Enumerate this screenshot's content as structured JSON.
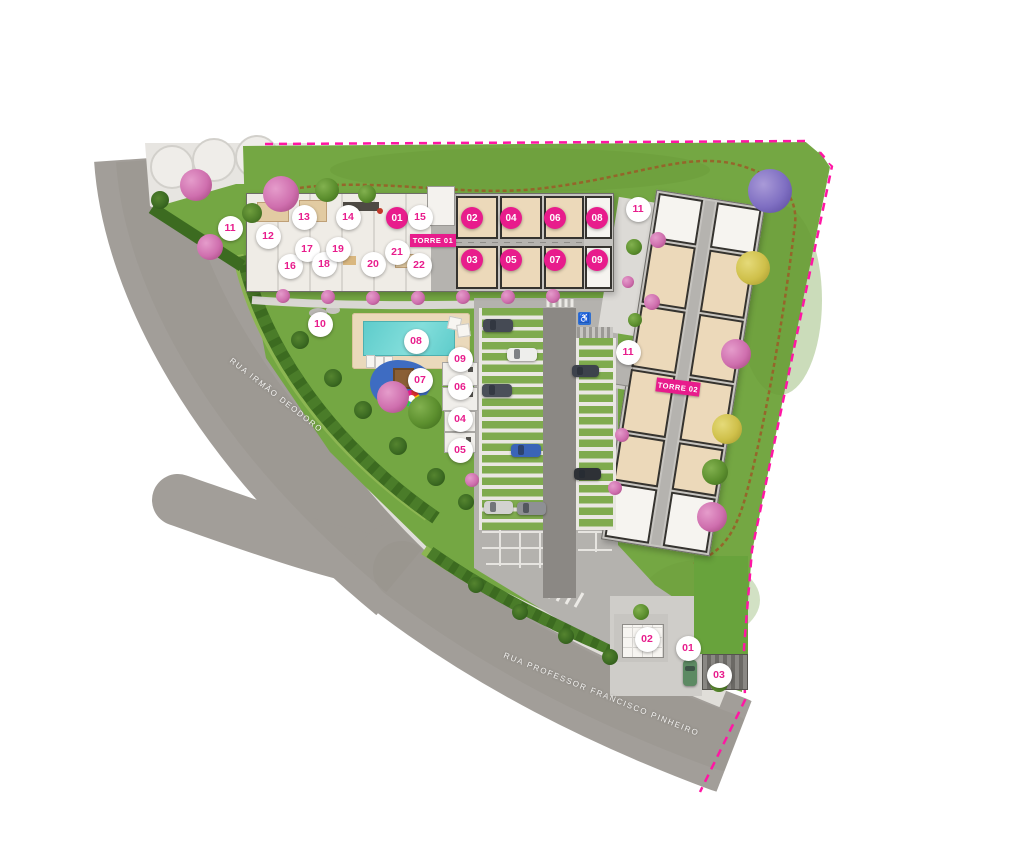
{
  "labels": {
    "torre1": "TORRE 01",
    "torre2": "TORRE 02",
    "street_left": "RUA IRMÃO DEODORO",
    "street_bottom": "RUA PROFESSOR FRANCISCO PINHEIRO"
  },
  "icons": {
    "accessible_parking": "♿"
  },
  "colors": {
    "marker_pink": "#e81c8c",
    "boundary_pink": "#ff16a4",
    "lawn_green": "#74a743",
    "road_gray": "#a29e99",
    "pool_aqua": "#5ecccb",
    "unit_beige": "#ecd9ba",
    "playground_blue": "#3e6cc2"
  },
  "unit_markers": [
    {
      "label": "01",
      "x": 397,
      "y": 218
    },
    {
      "label": "02",
      "x": 472,
      "y": 218
    },
    {
      "label": "04",
      "x": 511,
      "y": 218
    },
    {
      "label": "06",
      "x": 555,
      "y": 218
    },
    {
      "label": "08",
      "x": 597,
      "y": 218
    },
    {
      "label": "03",
      "x": 472,
      "y": 260
    },
    {
      "label": "05",
      "x": 511,
      "y": 260
    },
    {
      "label": "07",
      "x": 555,
      "y": 260
    },
    {
      "label": "09",
      "x": 597,
      "y": 260
    }
  ],
  "amenity_markers": [
    {
      "label": "11",
      "x": 230,
      "y": 228
    },
    {
      "label": "12",
      "x": 268,
      "y": 236
    },
    {
      "label": "13",
      "x": 304,
      "y": 217
    },
    {
      "label": "14",
      "x": 348,
      "y": 217
    },
    {
      "label": "15",
      "x": 420,
      "y": 217
    },
    {
      "label": "16",
      "x": 290,
      "y": 266
    },
    {
      "label": "17",
      "x": 307,
      "y": 249
    },
    {
      "label": "18",
      "x": 324,
      "y": 264
    },
    {
      "label": "19",
      "x": 338,
      "y": 249
    },
    {
      "label": "20",
      "x": 373,
      "y": 264
    },
    {
      "label": "21",
      "x": 397,
      "y": 252
    },
    {
      "label": "22",
      "x": 419,
      "y": 265
    },
    {
      "label": "10",
      "x": 320,
      "y": 324
    },
    {
      "label": "08",
      "x": 416,
      "y": 341
    },
    {
      "label": "07",
      "x": 420,
      "y": 380
    },
    {
      "label": "09",
      "x": 460,
      "y": 359
    },
    {
      "label": "06",
      "x": 460,
      "y": 387
    },
    {
      "label": "04",
      "x": 460,
      "y": 419
    },
    {
      "label": "05",
      "x": 460,
      "y": 450
    },
    {
      "label": "11",
      "x": 638,
      "y": 209
    },
    {
      "label": "11",
      "x": 628,
      "y": 352
    },
    {
      "label": "02",
      "x": 647,
      "y": 639
    },
    {
      "label": "01",
      "x": 688,
      "y": 648
    },
    {
      "label": "03",
      "x": 719,
      "y": 675
    }
  ],
  "trees": [
    {
      "t": "pink",
      "x": 196,
      "y": 185,
      "r": 16
    },
    {
      "t": "pink",
      "x": 281,
      "y": 194,
      "r": 18
    },
    {
      "t": "pink",
      "x": 210,
      "y": 247,
      "r": 13
    },
    {
      "t": "pink",
      "x": 393,
      "y": 397,
      "r": 16
    },
    {
      "t": "pink",
      "x": 736,
      "y": 354,
      "r": 15
    },
    {
      "t": "pink",
      "x": 712,
      "y": 517,
      "r": 15
    },
    {
      "t": "pinksmall",
      "x": 658,
      "y": 240,
      "r": 8
    },
    {
      "t": "pinksmall",
      "x": 652,
      "y": 302,
      "r": 8
    },
    {
      "t": "pinksmall",
      "x": 628,
      "y": 282,
      "r": 6
    },
    {
      "t": "pinksmall",
      "x": 622,
      "y": 435,
      "r": 7
    },
    {
      "t": "pinksmall",
      "x": 615,
      "y": 488,
      "r": 7
    },
    {
      "t": "pinksmall",
      "x": 472,
      "y": 480,
      "r": 7
    },
    {
      "t": "pinksmall",
      "x": 283,
      "y": 296,
      "r": 7
    },
    {
      "t": "pinksmall",
      "x": 328,
      "y": 297,
      "r": 7
    },
    {
      "t": "pinksmall",
      "x": 373,
      "y": 298,
      "r": 7
    },
    {
      "t": "pinksmall",
      "x": 418,
      "y": 298,
      "r": 7
    },
    {
      "t": "pinksmall",
      "x": 463,
      "y": 297,
      "r": 7
    },
    {
      "t": "pinksmall",
      "x": 508,
      "y": 297,
      "r": 7
    },
    {
      "t": "pinksmall",
      "x": 553,
      "y": 296,
      "r": 7
    },
    {
      "t": "purple",
      "x": 770,
      "y": 191,
      "r": 22
    },
    {
      "t": "yellow",
      "x": 753,
      "y": 268,
      "r": 17
    },
    {
      "t": "yellow",
      "x": 727,
      "y": 429,
      "r": 15
    },
    {
      "t": "green",
      "x": 425,
      "y": 412,
      "r": 17
    },
    {
      "t": "green",
      "x": 715,
      "y": 472,
      "r": 13
    },
    {
      "t": "green",
      "x": 327,
      "y": 190,
      "r": 12
    },
    {
      "t": "green",
      "x": 367,
      "y": 194,
      "r": 9
    },
    {
      "t": "green",
      "x": 634,
      "y": 247,
      "r": 8
    },
    {
      "t": "green",
      "x": 635,
      "y": 320,
      "r": 7
    },
    {
      "t": "green",
      "x": 641,
      "y": 612,
      "r": 8
    },
    {
      "t": "green",
      "x": 719,
      "y": 683,
      "r": 9
    },
    {
      "t": "bush",
      "x": 252,
      "y": 213,
      "r": 10
    },
    {
      "t": "palm",
      "x": 160,
      "y": 200,
      "r": 9
    },
    {
      "t": "palm",
      "x": 300,
      "y": 340,
      "r": 9
    },
    {
      "t": "palm",
      "x": 333,
      "y": 378,
      "r": 9
    },
    {
      "t": "palm",
      "x": 363,
      "y": 410,
      "r": 9
    },
    {
      "t": "palm",
      "x": 398,
      "y": 446,
      "r": 9
    },
    {
      "t": "palm",
      "x": 436,
      "y": 477,
      "r": 9
    },
    {
      "t": "palm",
      "x": 466,
      "y": 502,
      "r": 8
    },
    {
      "t": "palm",
      "x": 476,
      "y": 585,
      "r": 8
    },
    {
      "t": "palm",
      "x": 520,
      "y": 612,
      "r": 8
    },
    {
      "t": "palm",
      "x": 566,
      "y": 636,
      "r": 8
    },
    {
      "t": "palm",
      "x": 610,
      "y": 657,
      "r": 8
    }
  ],
  "cars": [
    {
      "x": 498,
      "y": 325,
      "w": 30,
      "h": 13,
      "c": "#454a54"
    },
    {
      "x": 522,
      "y": 354,
      "w": 30,
      "h": 13,
      "c": "#eeeeec"
    },
    {
      "x": 585,
      "y": 371,
      "w": 27,
      "h": 12,
      "c": "#3d424c"
    },
    {
      "x": 497,
      "y": 390,
      "w": 30,
      "h": 13,
      "c": "#4a4f59"
    },
    {
      "x": 526,
      "y": 450,
      "w": 30,
      "h": 13,
      "c": "#3a64b8"
    },
    {
      "x": 587,
      "y": 474,
      "w": 27,
      "h": 12,
      "c": "#2e3136"
    },
    {
      "x": 498,
      "y": 507,
      "w": 29,
      "h": 13,
      "c": "#d2d2d0"
    },
    {
      "x": 531,
      "y": 508,
      "w": 29,
      "h": 13,
      "c": "#8e9094"
    },
    {
      "x": 690,
      "y": 673,
      "w": 14,
      "h": 26,
      "c": "#5d8a63"
    }
  ]
}
